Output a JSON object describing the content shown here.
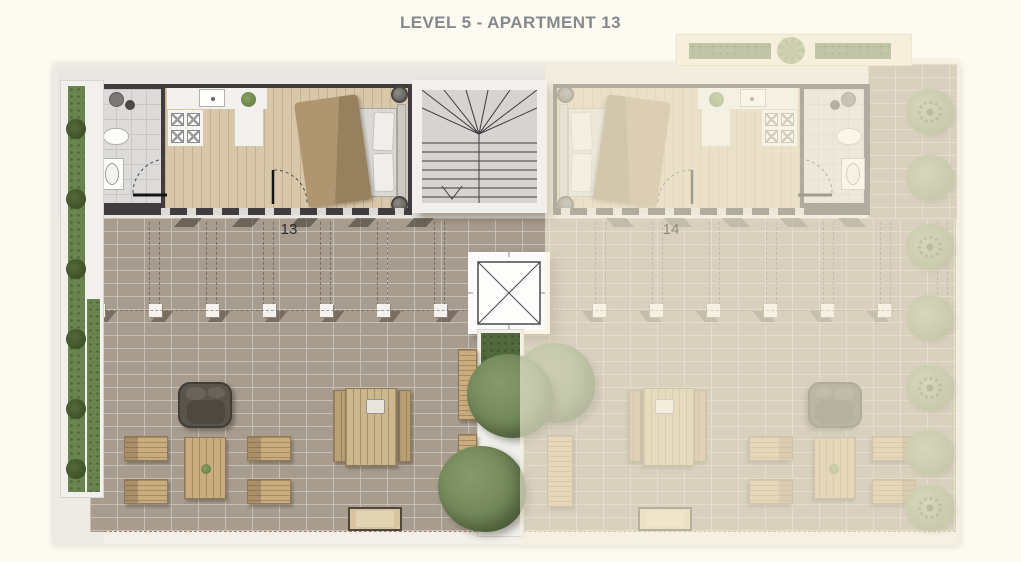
{
  "title": "LEVEL 5 - APARTMENT 13",
  "units": [
    {
      "label": "13",
      "state": "highlighted"
    },
    {
      "label": "14",
      "state": "faded"
    }
  ],
  "colors": {
    "background": "#fdfaf1",
    "title_text": "#85898c",
    "highlighted_paving": "#a89c8f",
    "faded_wash": "#f7f0dc",
    "walls": "#3f3d3e",
    "wood_floor": "#d8c7a9",
    "greenery": "#6f8657"
  }
}
